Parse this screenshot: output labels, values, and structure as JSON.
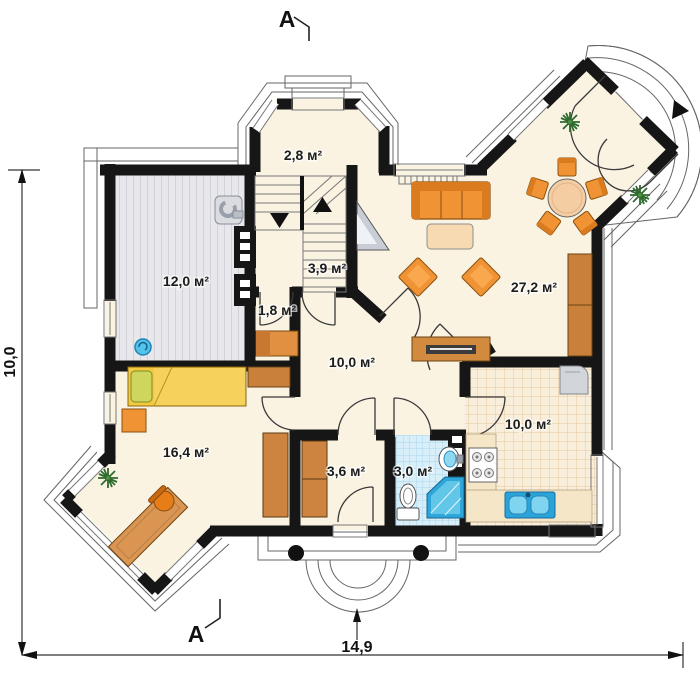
{
  "section": {
    "label": "A"
  },
  "dimensions": {
    "vertical": "10,0",
    "horizontal": "14,9"
  },
  "rooms": {
    "vestibule": {
      "area": "2,8 м²"
    },
    "staircase": {
      "area": "3,9 м²"
    },
    "closet": {
      "area": "1,8 м²"
    },
    "garage": {
      "area": "12,0 м²"
    },
    "hall": {
      "area": "10,0 м²"
    },
    "living_room": {
      "area": "27,2 м²"
    },
    "bedroom": {
      "area": "16,4 м²"
    },
    "corridor": {
      "area": "3,6 м²"
    },
    "bathroom": {
      "area": "3,0 м²"
    },
    "kitchen": {
      "area": "10,0 м²"
    }
  },
  "furniture_icons": [
    "sofa",
    "coffee-table",
    "armchair",
    "dining-table",
    "dining-chair",
    "sideboard",
    "cabinet",
    "corner-tv-unit",
    "bed",
    "nightstand",
    "dresser",
    "wardrobe",
    "desk",
    "office-chair",
    "plant",
    "stove",
    "kitchen-sink",
    "fridge",
    "counter",
    "toilet",
    "wash-basin",
    "shower",
    "water-heater",
    "floor-drain",
    "stairs",
    "porch-column"
  ],
  "colors": {
    "wall": "#161616",
    "floor_cream": "#faf3e2",
    "roof_outline": "#f8f1e1",
    "garage_gray": "#e8e8ec",
    "kitchen_tile": "#f9eedb",
    "bath_tile": "#d8eef9",
    "furniture_orange": "#ef9334",
    "wood_brown": "#cd8440",
    "bed_yellow": "#f4c93e",
    "pillow_green": "#cfd65e",
    "shower_blue": "#2ea6da",
    "sink_blue": "#7fd4f0"
  }
}
